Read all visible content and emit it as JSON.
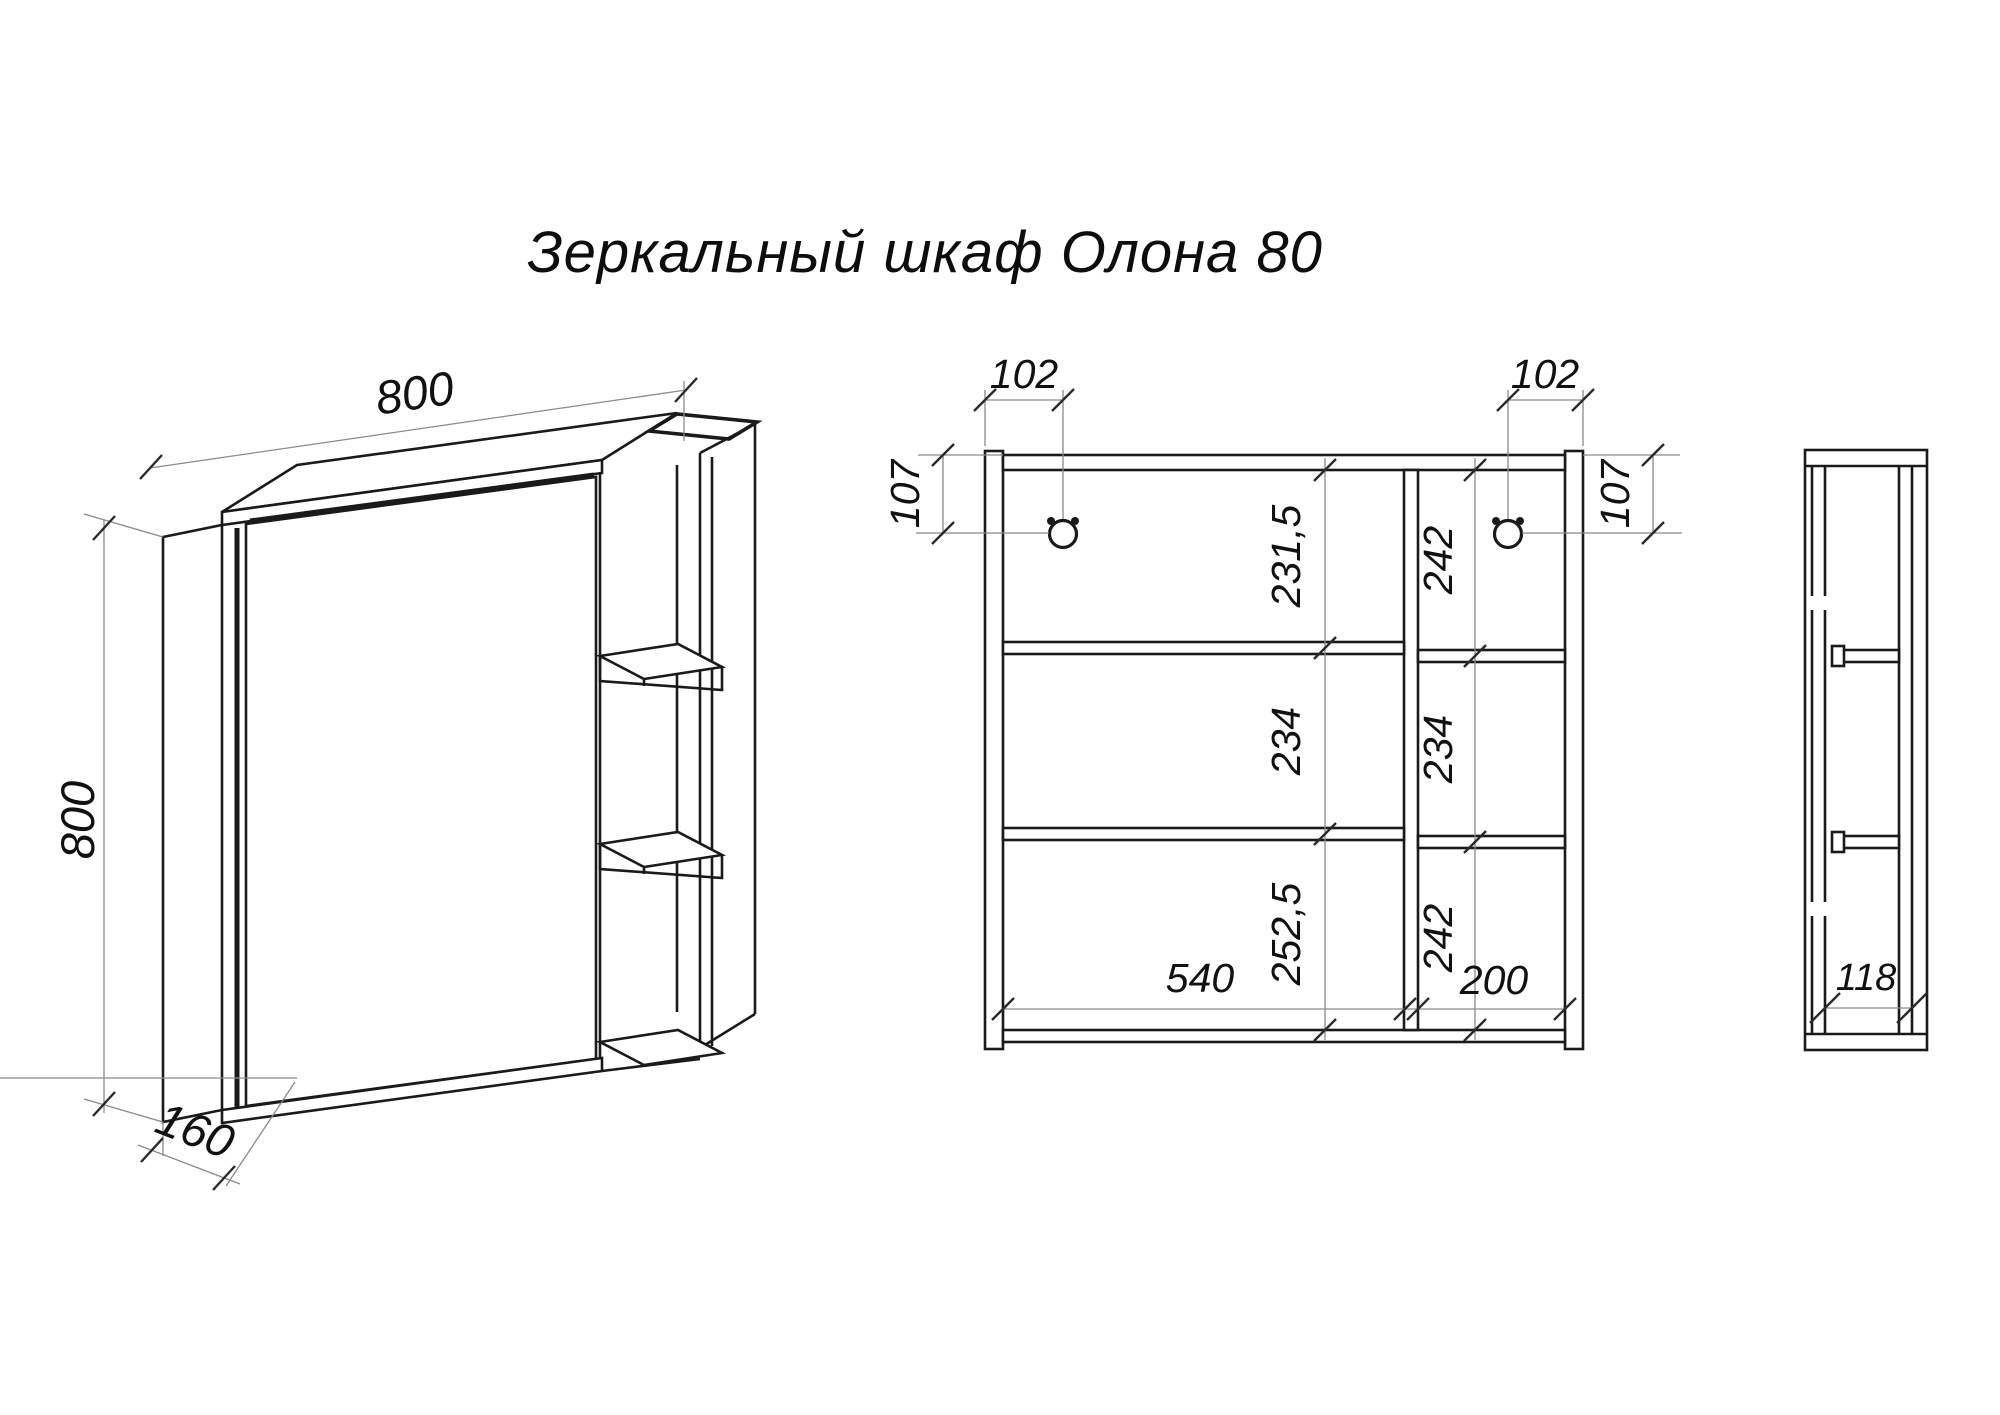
{
  "title": {
    "text": "Зеркальный шкаф Олона 80"
  },
  "perspective": {
    "width": "800",
    "height": "800",
    "depth": "160"
  },
  "front": {
    "offset_top_left": "102",
    "offset_top_right": "102",
    "side_offset_left": "107",
    "side_offset_right": "107",
    "left_column": {
      "rows": [
        "231,5",
        "234",
        "252,5"
      ]
    },
    "right_column": {
      "rows": [
        "242",
        "234",
        "242"
      ]
    },
    "bottom": {
      "left_width": "540",
      "right_width": "200"
    }
  },
  "side": {
    "inner_depth": "118"
  },
  "colors": {
    "line": "#1a1a1a",
    "dimension_line": "#8a8a8a",
    "text": "#111111",
    "background": "#ffffff"
  }
}
